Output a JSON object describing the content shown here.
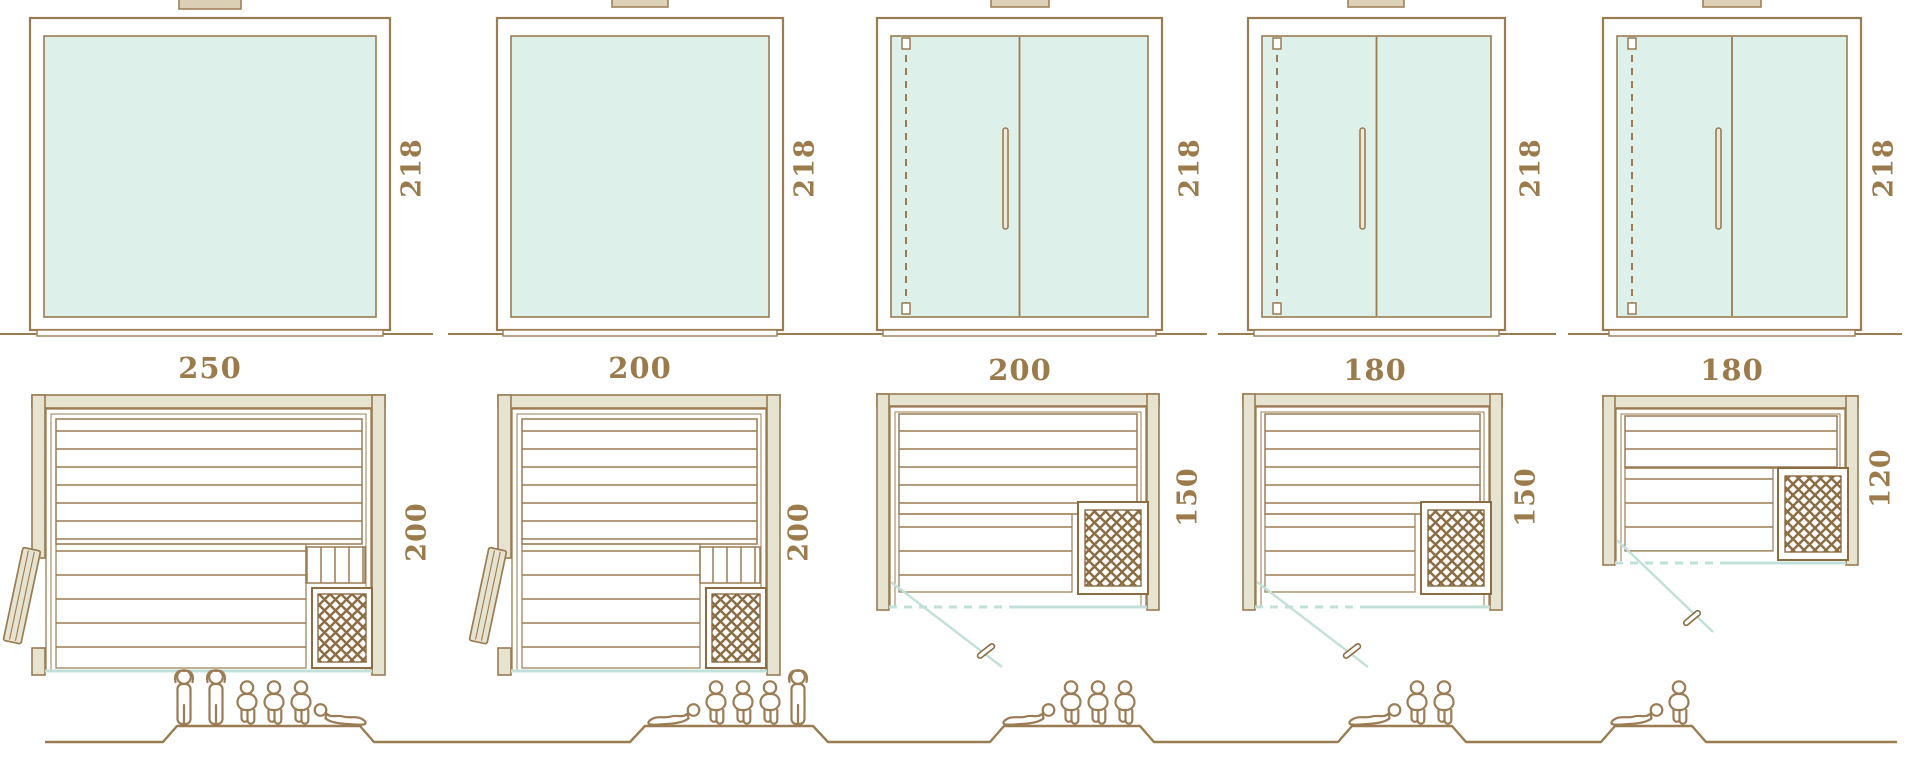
{
  "colors": {
    "line_brown": "#9a7c52",
    "line_dark_brown": "#8b6c43",
    "wall_fill": "#e6e3d1",
    "glass_fill": "#def0ea",
    "glass_line_blue": "#c2e0da",
    "dimension_text": "#9b7b4b"
  },
  "models": [
    {
      "name": "sauna-250x200",
      "width_label": "250",
      "height_label": "218",
      "depth_label": "200",
      "capacity": 6,
      "front": "fixed-glass-panel",
      "plan_door": "side-hinged-door",
      "people": [
        "standing",
        "standing",
        "sitting",
        "sitting",
        "sitting",
        "lying-flip"
      ]
    },
    {
      "name": "sauna-200x200",
      "width_label": "200",
      "height_label": "218",
      "depth_label": "200",
      "capacity": 5,
      "front": "fixed-glass-panel",
      "plan_door": "side-hinged-door",
      "people": [
        "lying",
        "sitting",
        "sitting",
        "sitting",
        "standing"
      ]
    },
    {
      "name": "sauna-200x150",
      "width_label": "200",
      "height_label": "218",
      "depth_label": "150",
      "capacity": 4,
      "front": "double-glass-door",
      "plan_door": "front-glass-door",
      "people": [
        "lying",
        "sitting",
        "sitting",
        "sitting"
      ]
    },
    {
      "name": "sauna-180x150",
      "width_label": "180",
      "height_label": "218",
      "depth_label": "150",
      "capacity": 3,
      "front": "double-glass-door",
      "plan_door": "front-glass-door",
      "people": [
        "lying",
        "sitting",
        "sitting"
      ]
    },
    {
      "name": "sauna-180x120",
      "width_label": "180",
      "height_label": "218",
      "depth_label": "120",
      "capacity": 2,
      "front": "double-glass-door",
      "plan_door": "front-glass-door",
      "people": [
        "lying",
        "sitting"
      ]
    }
  ]
}
